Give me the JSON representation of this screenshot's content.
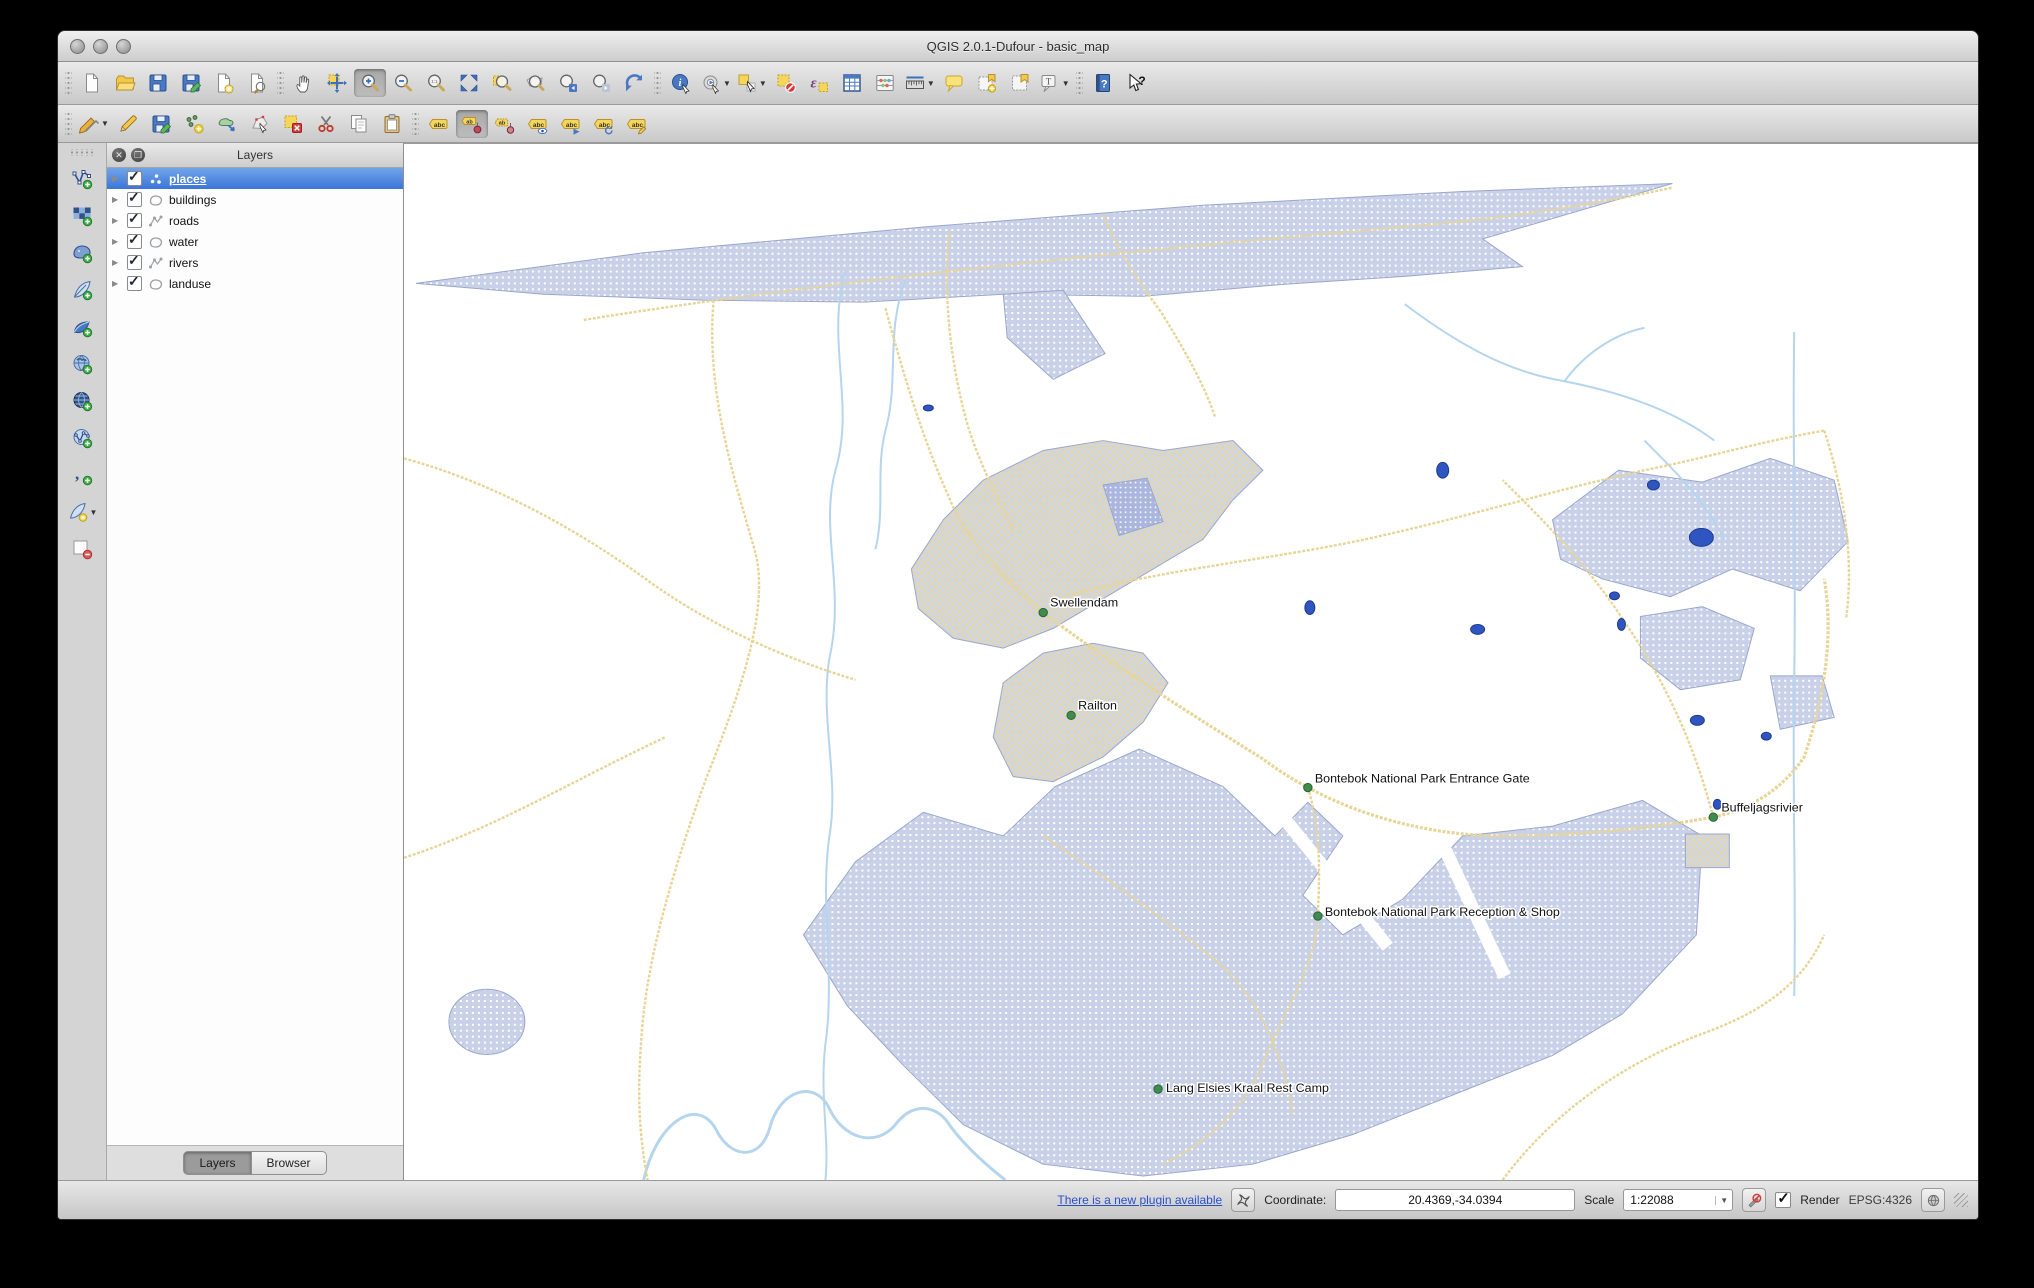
{
  "window": {
    "title": "QGIS 2.0.1-Dufour - basic_map"
  },
  "toolbars": {
    "main": [
      {
        "kind": "sep"
      },
      {
        "name": "new-project",
        "icon": "page"
      },
      {
        "name": "open-project",
        "icon": "folder"
      },
      {
        "name": "save-project",
        "icon": "disk"
      },
      {
        "name": "save-project-as",
        "icon": "disk-pencil"
      },
      {
        "name": "new-print-composer",
        "icon": "page-star"
      },
      {
        "name": "composer-manager",
        "icon": "page-wrench"
      },
      {
        "kind": "sep"
      },
      {
        "name": "pan-map",
        "icon": "hand"
      },
      {
        "name": "pan-to-selection",
        "icon": "pan-selection"
      },
      {
        "name": "zoom-in",
        "icon": "mag-plus",
        "active": true
      },
      {
        "name": "zoom-out",
        "icon": "mag-minus"
      },
      {
        "name": "zoom-native",
        "icon": "mag-native"
      },
      {
        "name": "zoom-full",
        "icon": "zoom-full"
      },
      {
        "name": "zoom-to-selection",
        "icon": "mag-selection"
      },
      {
        "name": "zoom-to-layer",
        "icon": "mag-layer"
      },
      {
        "name": "zoom-last",
        "icon": "mag-last"
      },
      {
        "name": "zoom-next",
        "icon": "mag-next"
      },
      {
        "name": "map-refresh",
        "icon": "refresh"
      },
      {
        "kind": "sep"
      },
      {
        "name": "identify-features",
        "icon": "identify"
      },
      {
        "name": "run-feature-action",
        "icon": "action",
        "dropdown": true
      },
      {
        "name": "select-features",
        "icon": "select",
        "dropdown": true
      },
      {
        "name": "deselect-features",
        "icon": "deselect"
      },
      {
        "name": "select-by-expression",
        "icon": "expression"
      },
      {
        "name": "open-attribute-table",
        "icon": "table"
      },
      {
        "name": "field-calculator",
        "icon": "abacus"
      },
      {
        "name": "measure-line",
        "icon": "ruler",
        "dropdown": true
      },
      {
        "name": "map-tips",
        "icon": "bubble"
      },
      {
        "name": "new-bookmark",
        "icon": "bookmark-new"
      },
      {
        "name": "show-bookmarks",
        "icon": "bookmark"
      },
      {
        "name": "text-annotation",
        "icon": "annotation",
        "dropdown": true
      },
      {
        "kind": "sep"
      },
      {
        "name": "help-contents",
        "icon": "help"
      },
      {
        "name": "whats-this",
        "icon": "whats-this"
      }
    ],
    "digitizing": [
      {
        "kind": "sep"
      },
      {
        "name": "current-edits",
        "icon": "pencil-stack",
        "dropdown": true
      },
      {
        "name": "toggle-editing",
        "icon": "pencil"
      },
      {
        "name": "save-layer-edits",
        "icon": "disk-pencil"
      },
      {
        "name": "add-feature",
        "icon": "add-points"
      },
      {
        "name": "move-feature",
        "icon": "move-feature"
      },
      {
        "name": "node-tool",
        "icon": "node-tool"
      },
      {
        "name": "delete-selected",
        "icon": "delete-selected"
      },
      {
        "name": "cut-features",
        "icon": "scissors"
      },
      {
        "name": "copy-features",
        "icon": "copy"
      },
      {
        "name": "paste-features",
        "icon": "paste"
      },
      {
        "kind": "sep"
      },
      {
        "name": "labeling-options",
        "icon": "label-abc"
      },
      {
        "name": "pin-unpin-labels",
        "icon": "label-pin",
        "active": true
      },
      {
        "name": "highlight-pinned-labels",
        "icon": "label-pin2"
      },
      {
        "name": "show-hide-labels",
        "icon": "label-eye"
      },
      {
        "name": "move-label",
        "icon": "label-move"
      },
      {
        "name": "rotate-label",
        "icon": "label-rotate"
      },
      {
        "name": "change-label",
        "icon": "label-change"
      }
    ],
    "manage_layers": [
      {
        "kind": "sep"
      },
      {
        "name": "add-vector-layer",
        "icon": "vector-add"
      },
      {
        "name": "add-raster-layer",
        "icon": "raster-add"
      },
      {
        "name": "add-postgis-layer",
        "icon": "postgis-add"
      },
      {
        "name": "add-spatialite-layer",
        "icon": "spatialite-add"
      },
      {
        "name": "add-mssql-layer",
        "icon": "mssql-add"
      },
      {
        "name": "add-wms-layer",
        "icon": "wms-add"
      },
      {
        "name": "add-wcs-layer",
        "icon": "wcs-add"
      },
      {
        "name": "add-wfs-layer",
        "icon": "wfs-add"
      },
      {
        "name": "add-delimited-text-layer",
        "icon": "comma-add"
      },
      {
        "name": "new-shapefile-layer",
        "icon": "shapefile-new",
        "dropdown": true
      },
      {
        "name": "remove-layer",
        "icon": "remove-layer"
      }
    ]
  },
  "layers_panel": {
    "title": "Layers",
    "layers": [
      {
        "label": "places",
        "type": "point",
        "checked": true,
        "selected": true
      },
      {
        "label": "buildings",
        "type": "polygon",
        "checked": true,
        "selected": false
      },
      {
        "label": "roads",
        "type": "line",
        "checked": true,
        "selected": false
      },
      {
        "label": "water",
        "type": "polygon",
        "checked": true,
        "selected": false
      },
      {
        "label": "rivers",
        "type": "line",
        "checked": true,
        "selected": false
      },
      {
        "label": "landuse",
        "type": "polygon",
        "checked": true,
        "selected": false
      }
    ],
    "tabs": [
      {
        "label": "Layers",
        "active": true
      },
      {
        "label": "Browser",
        "active": false
      }
    ]
  },
  "map": {
    "place_labels": [
      {
        "text": "Swellendam",
        "x": 640,
        "y": 474,
        "dx": 7,
        "dy": -6
      },
      {
        "text": "Railton",
        "x": 668,
        "y": 578,
        "dx": 7,
        "dy": -6
      },
      {
        "text": "Bontebok National Park Entrance Gate",
        "x": 905,
        "y": 651,
        "dx": 7,
        "dy": -5
      },
      {
        "text": "Buffeljagsrivier",
        "x": 1311,
        "y": 681,
        "dx": 8,
        "dy": -6
      },
      {
        "text": "Bontebok National Park Reception & Shop",
        "x": 915,
        "y": 781,
        "dx": 7,
        "dy": 0
      },
      {
        "text": "Lang Elsies Kraal Rest Camp",
        "x": 755,
        "y": 956,
        "dx": 8,
        "dy": 3
      }
    ],
    "water_points": [
      [
        1040,
        330,
        6,
        8
      ],
      [
        907,
        469,
        5,
        7
      ],
      [
        1075,
        491,
        7,
        5
      ],
      [
        1212,
        457,
        5,
        4
      ],
      [
        1219,
        486,
        4,
        6
      ],
      [
        1251,
        345,
        6,
        5
      ],
      [
        1299,
        398,
        12,
        9
      ],
      [
        1295,
        583,
        7,
        5
      ],
      [
        1364,
        599,
        5,
        4
      ],
      [
        1315,
        668,
        4,
        5
      ],
      [
        525,
        267,
        5,
        3
      ]
    ],
    "colors": {
      "landuse": "#c9d1e9",
      "urban_street": "#e8d79a",
      "road": "#e7d597",
      "river": "#b5d5ee",
      "water": "#2e55c0",
      "place_dot": "#3f8c4f",
      "selection": "#3b75d9"
    }
  },
  "statusbar": {
    "plugin_link": "There is a new plugin available",
    "coordinate_label": "Coordinate:",
    "coordinate_value": "20.4369,-34.0394",
    "scale_label": "Scale",
    "scale_value": "1:22088",
    "render_label": "Render",
    "crs_label": "EPSG:4326"
  }
}
